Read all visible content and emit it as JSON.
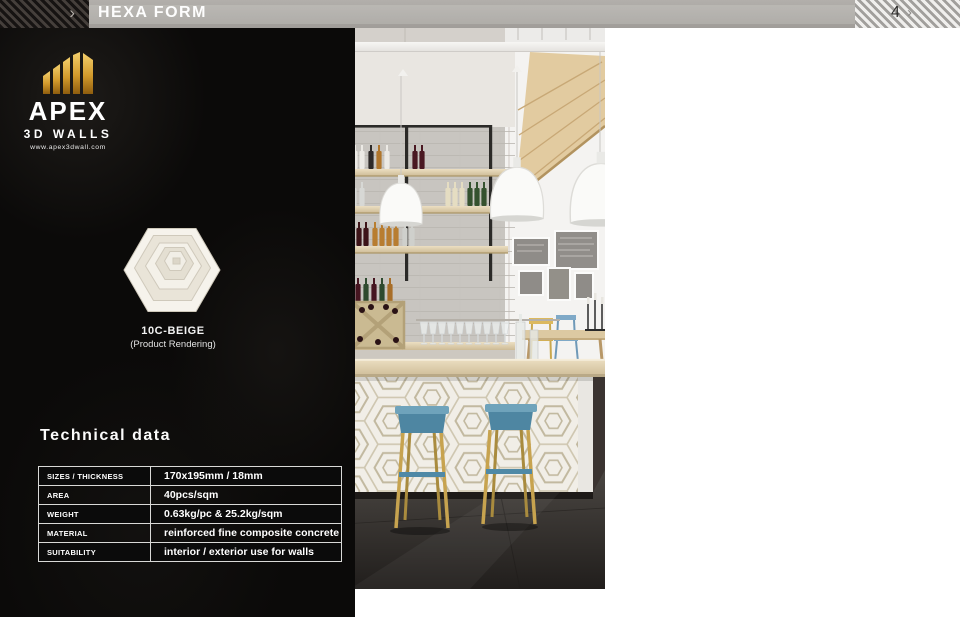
{
  "header": {
    "title": "HEXA FORM",
    "page_number": "4"
  },
  "icons": {
    "chevron_right": "›"
  },
  "brand": {
    "name": "APEX",
    "tagline": "3D WALLS",
    "website": "www.apex3dwall.com"
  },
  "product": {
    "code": "10C-BEIGE",
    "note": "(Product Rendering)"
  },
  "technical": {
    "heading": "Technical data",
    "rows": [
      {
        "label": "SIZES / THICKNESS",
        "value": "170x195mm / 18mm"
      },
      {
        "label": "AREA",
        "value": "40pcs/sqm"
      },
      {
        "label": "WEIGHT",
        "value": "0.63kg/pc  &  25.2kg/sqm"
      },
      {
        "label": "MATERIAL",
        "value": "reinforced fine composite concrete"
      },
      {
        "label": "SUITABILITY",
        "value": "interior / exterior use for walls"
      }
    ]
  },
  "photo": {
    "alt": "Bar interior with hexagonal 3D wall panels on a column and on the bar front, wooden shelves with wine bottles, white pendant lamps and two blue bar stools"
  },
  "colors": {
    "gold": "#d8a94a",
    "panel_black": "#0b0a09",
    "header_gray": "#a8a5a1",
    "row_black": "#0b0b0b",
    "row_gray": "#989896",
    "stool_blue": "#5e93ad",
    "wood": "#e4d4ae"
  }
}
